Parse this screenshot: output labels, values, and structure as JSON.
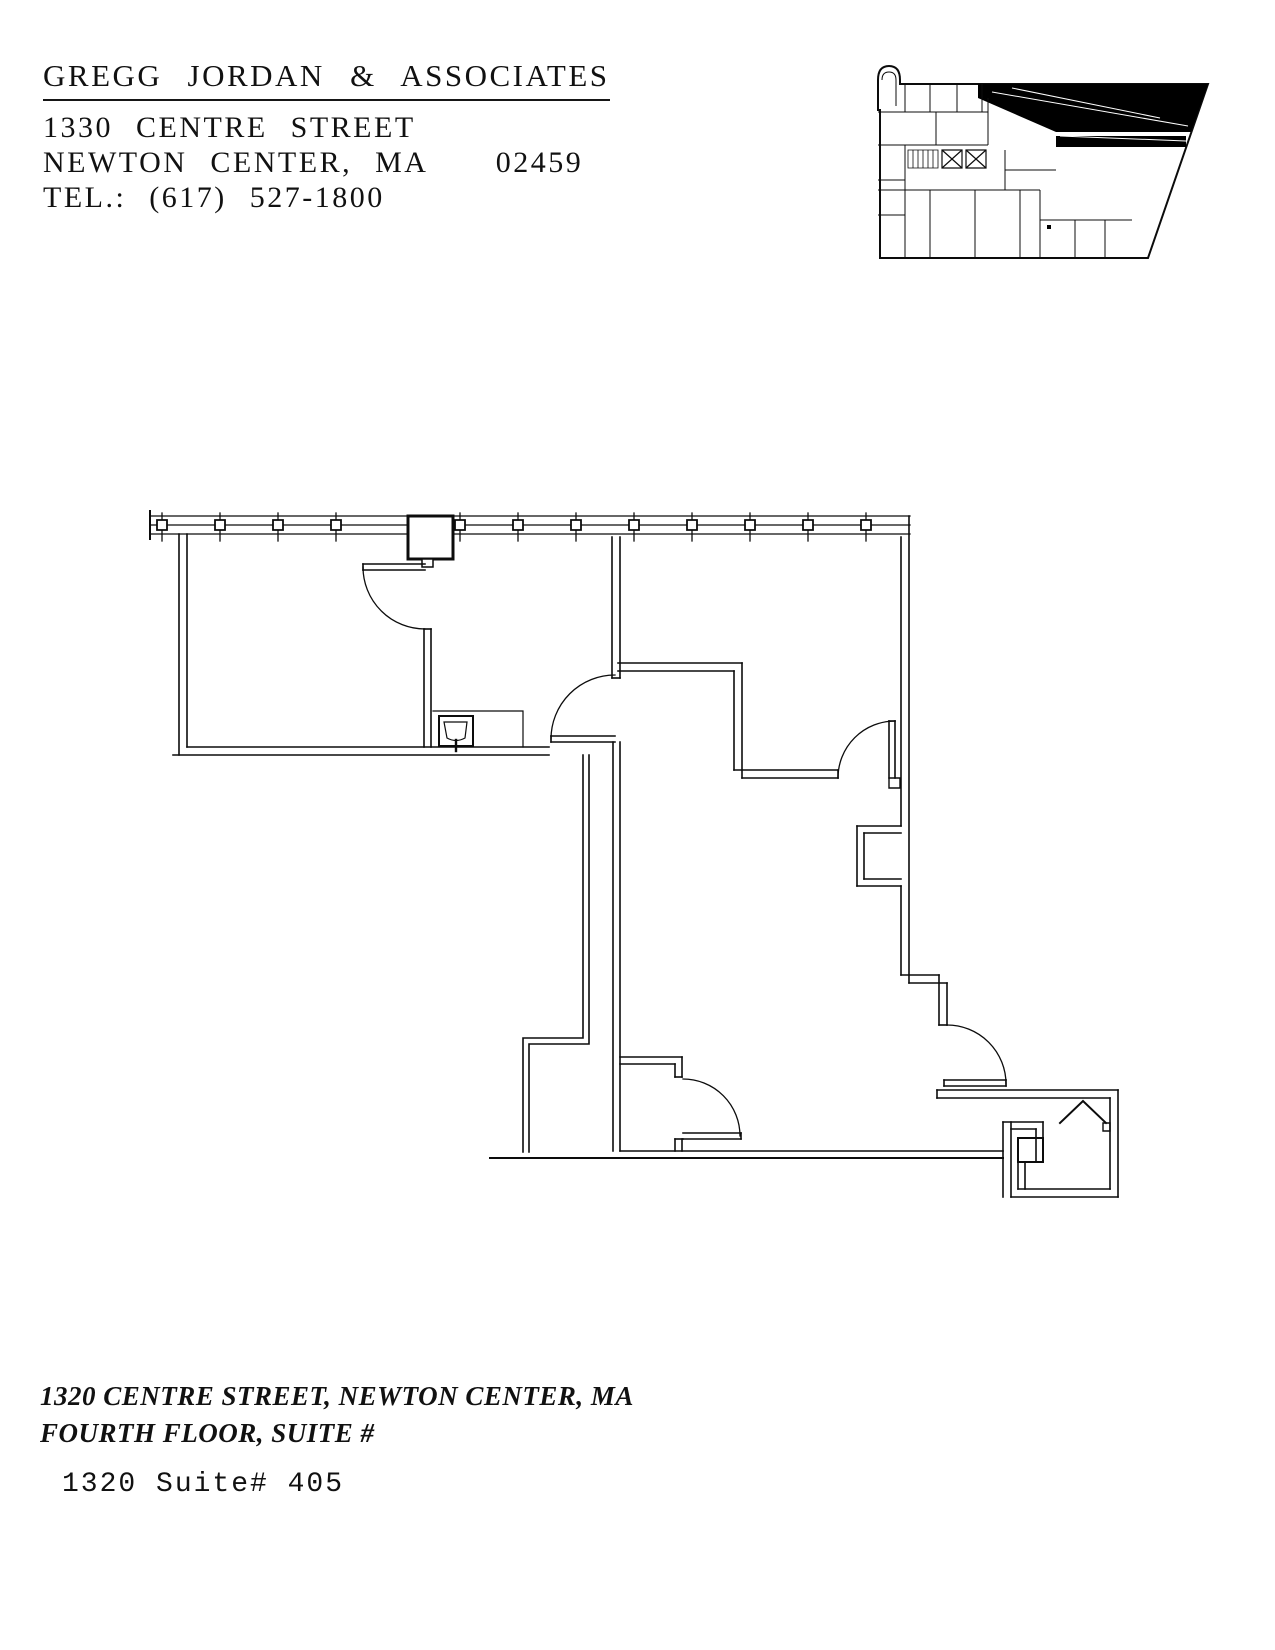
{
  "page": {
    "background_color": "#ffffff",
    "ink_color": "#0c0c0c"
  },
  "header": {
    "company": "GREGG JORDAN & ASSOCIATES",
    "address_line1": "1330 CENTRE STREET",
    "address_line2": "NEWTON CENTER, MA   02459",
    "phone": "TEL.: (617) 527-1800"
  },
  "drawing": {
    "key_plan": "building key plan with suite location shaded black (top right wing)",
    "main_plan": "suite floor plan: window wall with mullions at top, two offices, kitchenette with sink counter, corridor, open area, small office and closet at bottom right, five door swings"
  },
  "footer": {
    "location_line1": "1320 CENTRE STREET, NEWTON CENTER, MA",
    "location_line2": "FOURTH FLOOR, SUITE #",
    "suite_label": "1320 Suite# 405"
  }
}
